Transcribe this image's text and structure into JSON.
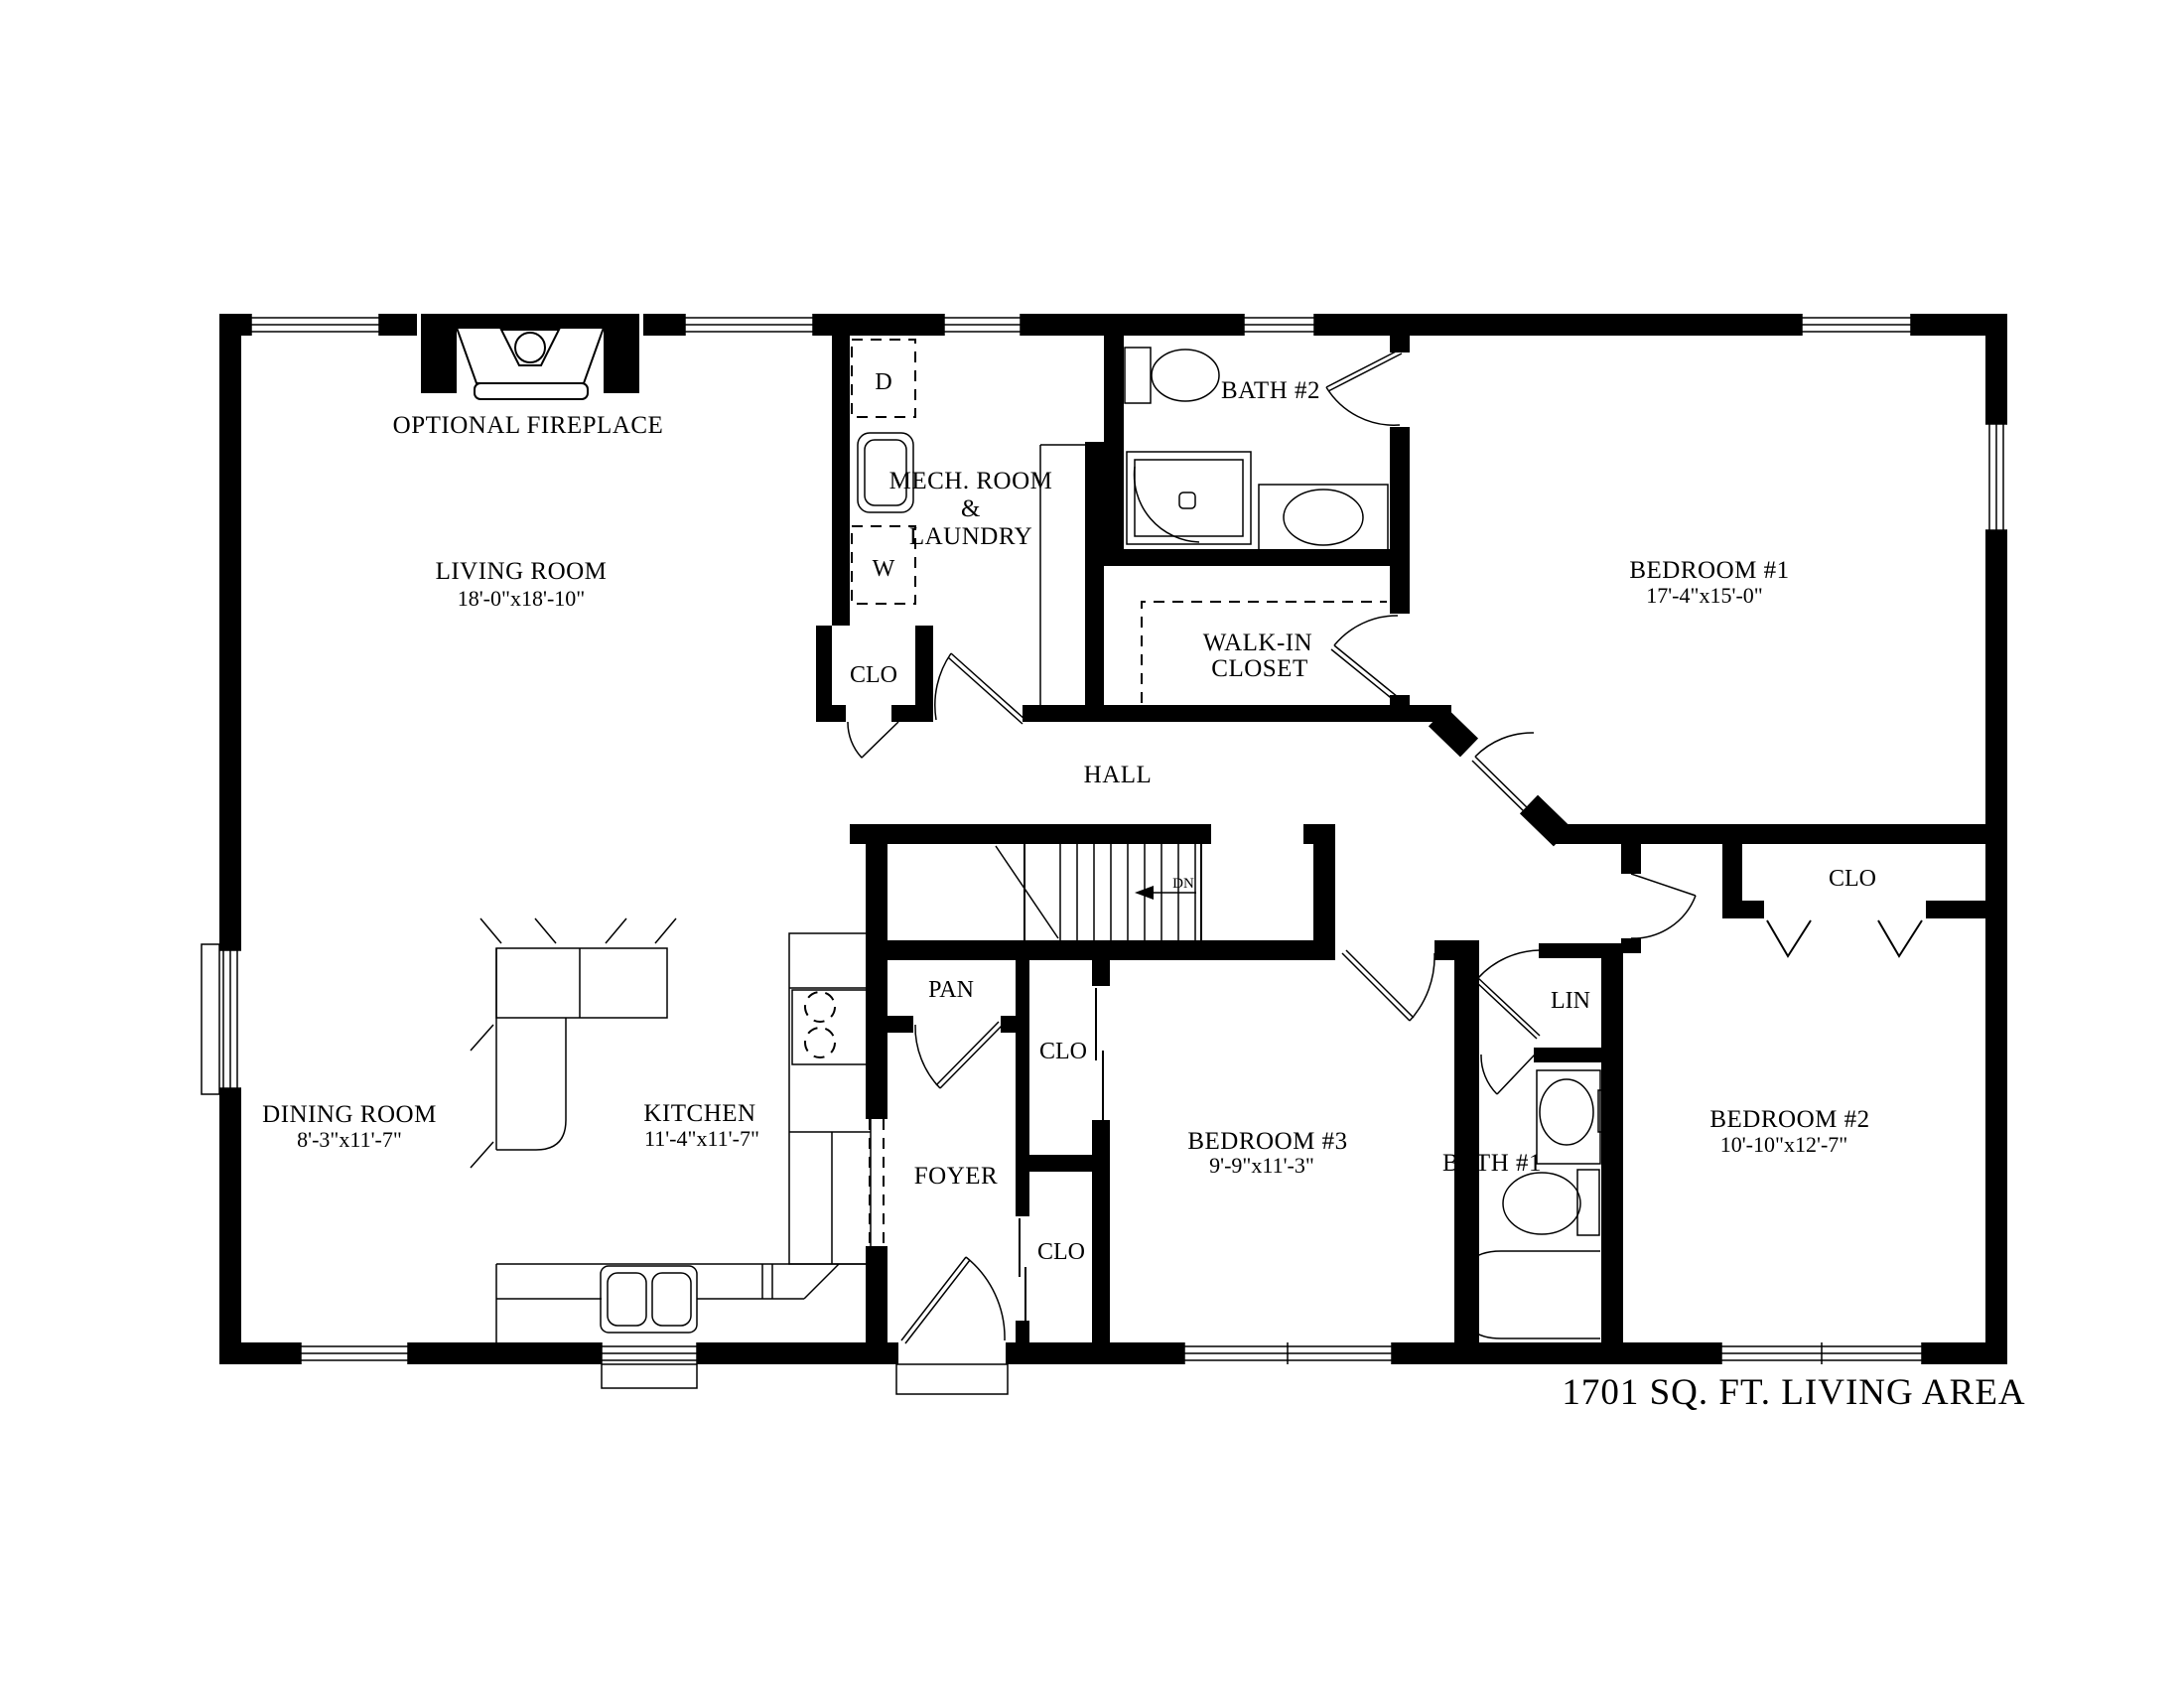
{
  "page": {
    "background": "#ffffff",
    "ink": "#000000"
  },
  "footer": {
    "area_label": "1701 SQ. FT. LIVING AREA"
  },
  "rooms": {
    "living": {
      "name": "LIVING ROOM",
      "dims": "18'-0\"x18'-10\""
    },
    "dining": {
      "name": "DINING ROOM",
      "dims": "8'-3\"x11'-7\""
    },
    "kitchen": {
      "name": "KITCHEN",
      "dims": "11'-4\"x11'-7\""
    },
    "bedroom1": {
      "name": "BEDROOM #1",
      "dims": "17'-4\"x15'-0\""
    },
    "bedroom2": {
      "name": "BEDROOM #2",
      "dims": "10'-10\"x12'-7\""
    },
    "bedroom3": {
      "name": "BEDROOM #3",
      "dims": "9'-9\"x11'-3\""
    },
    "bath1": {
      "name": "BATH #1"
    },
    "bath2": {
      "name": "BATH #2"
    },
    "hall": {
      "name": "HALL"
    },
    "foyer": {
      "name": "FOYER"
    },
    "pantry": {
      "name": "PAN"
    },
    "linen": {
      "name": "LIN"
    },
    "mech": {
      "line1": "MECH. ROOM",
      "line2": "&",
      "line3": "LAUNDRY"
    },
    "walkin": {
      "line1": "WALK-IN",
      "line2": "CLOSET"
    }
  },
  "labels": {
    "optional_fireplace": "OPTIONAL FIREPLACE",
    "closet_abbr": "CLO",
    "dryer": "D",
    "washer": "W",
    "down_abbr": "DN"
  }
}
